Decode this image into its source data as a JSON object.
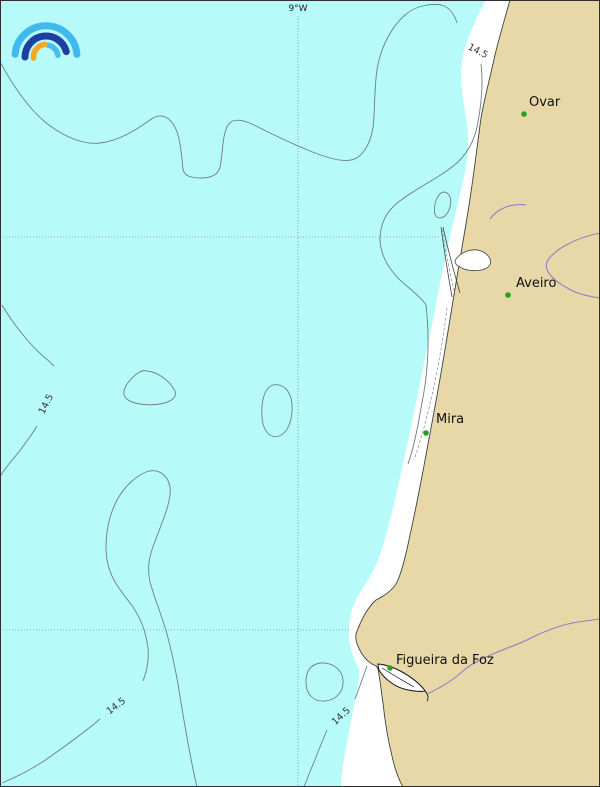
{
  "map": {
    "meridian_label": "9°W",
    "contour_value": "14.5",
    "cities": [
      {
        "name": "Ovar"
      },
      {
        "name": "Aveiro"
      },
      {
        "name": "Mira"
      },
      {
        "name": "Figueira da Foz"
      }
    ],
    "colors": {
      "sea": "#b6fbf9",
      "land": "#e8d8a7",
      "beach": "#ffffff",
      "contour": "#6e7e7e",
      "coastline": "#3d4343",
      "river": "#8d7fcb",
      "grid": "#8a8a8a",
      "city_dot": "#23a123",
      "city_text": "#111111",
      "contour_text": "#333333",
      "border": "#2f2f2f"
    },
    "logo": {
      "outer_color": "#3fb9ee",
      "middle_color": "#1d3fa3",
      "inner_color": "#49bdf0",
      "orange_color": "#f7a823"
    }
  }
}
